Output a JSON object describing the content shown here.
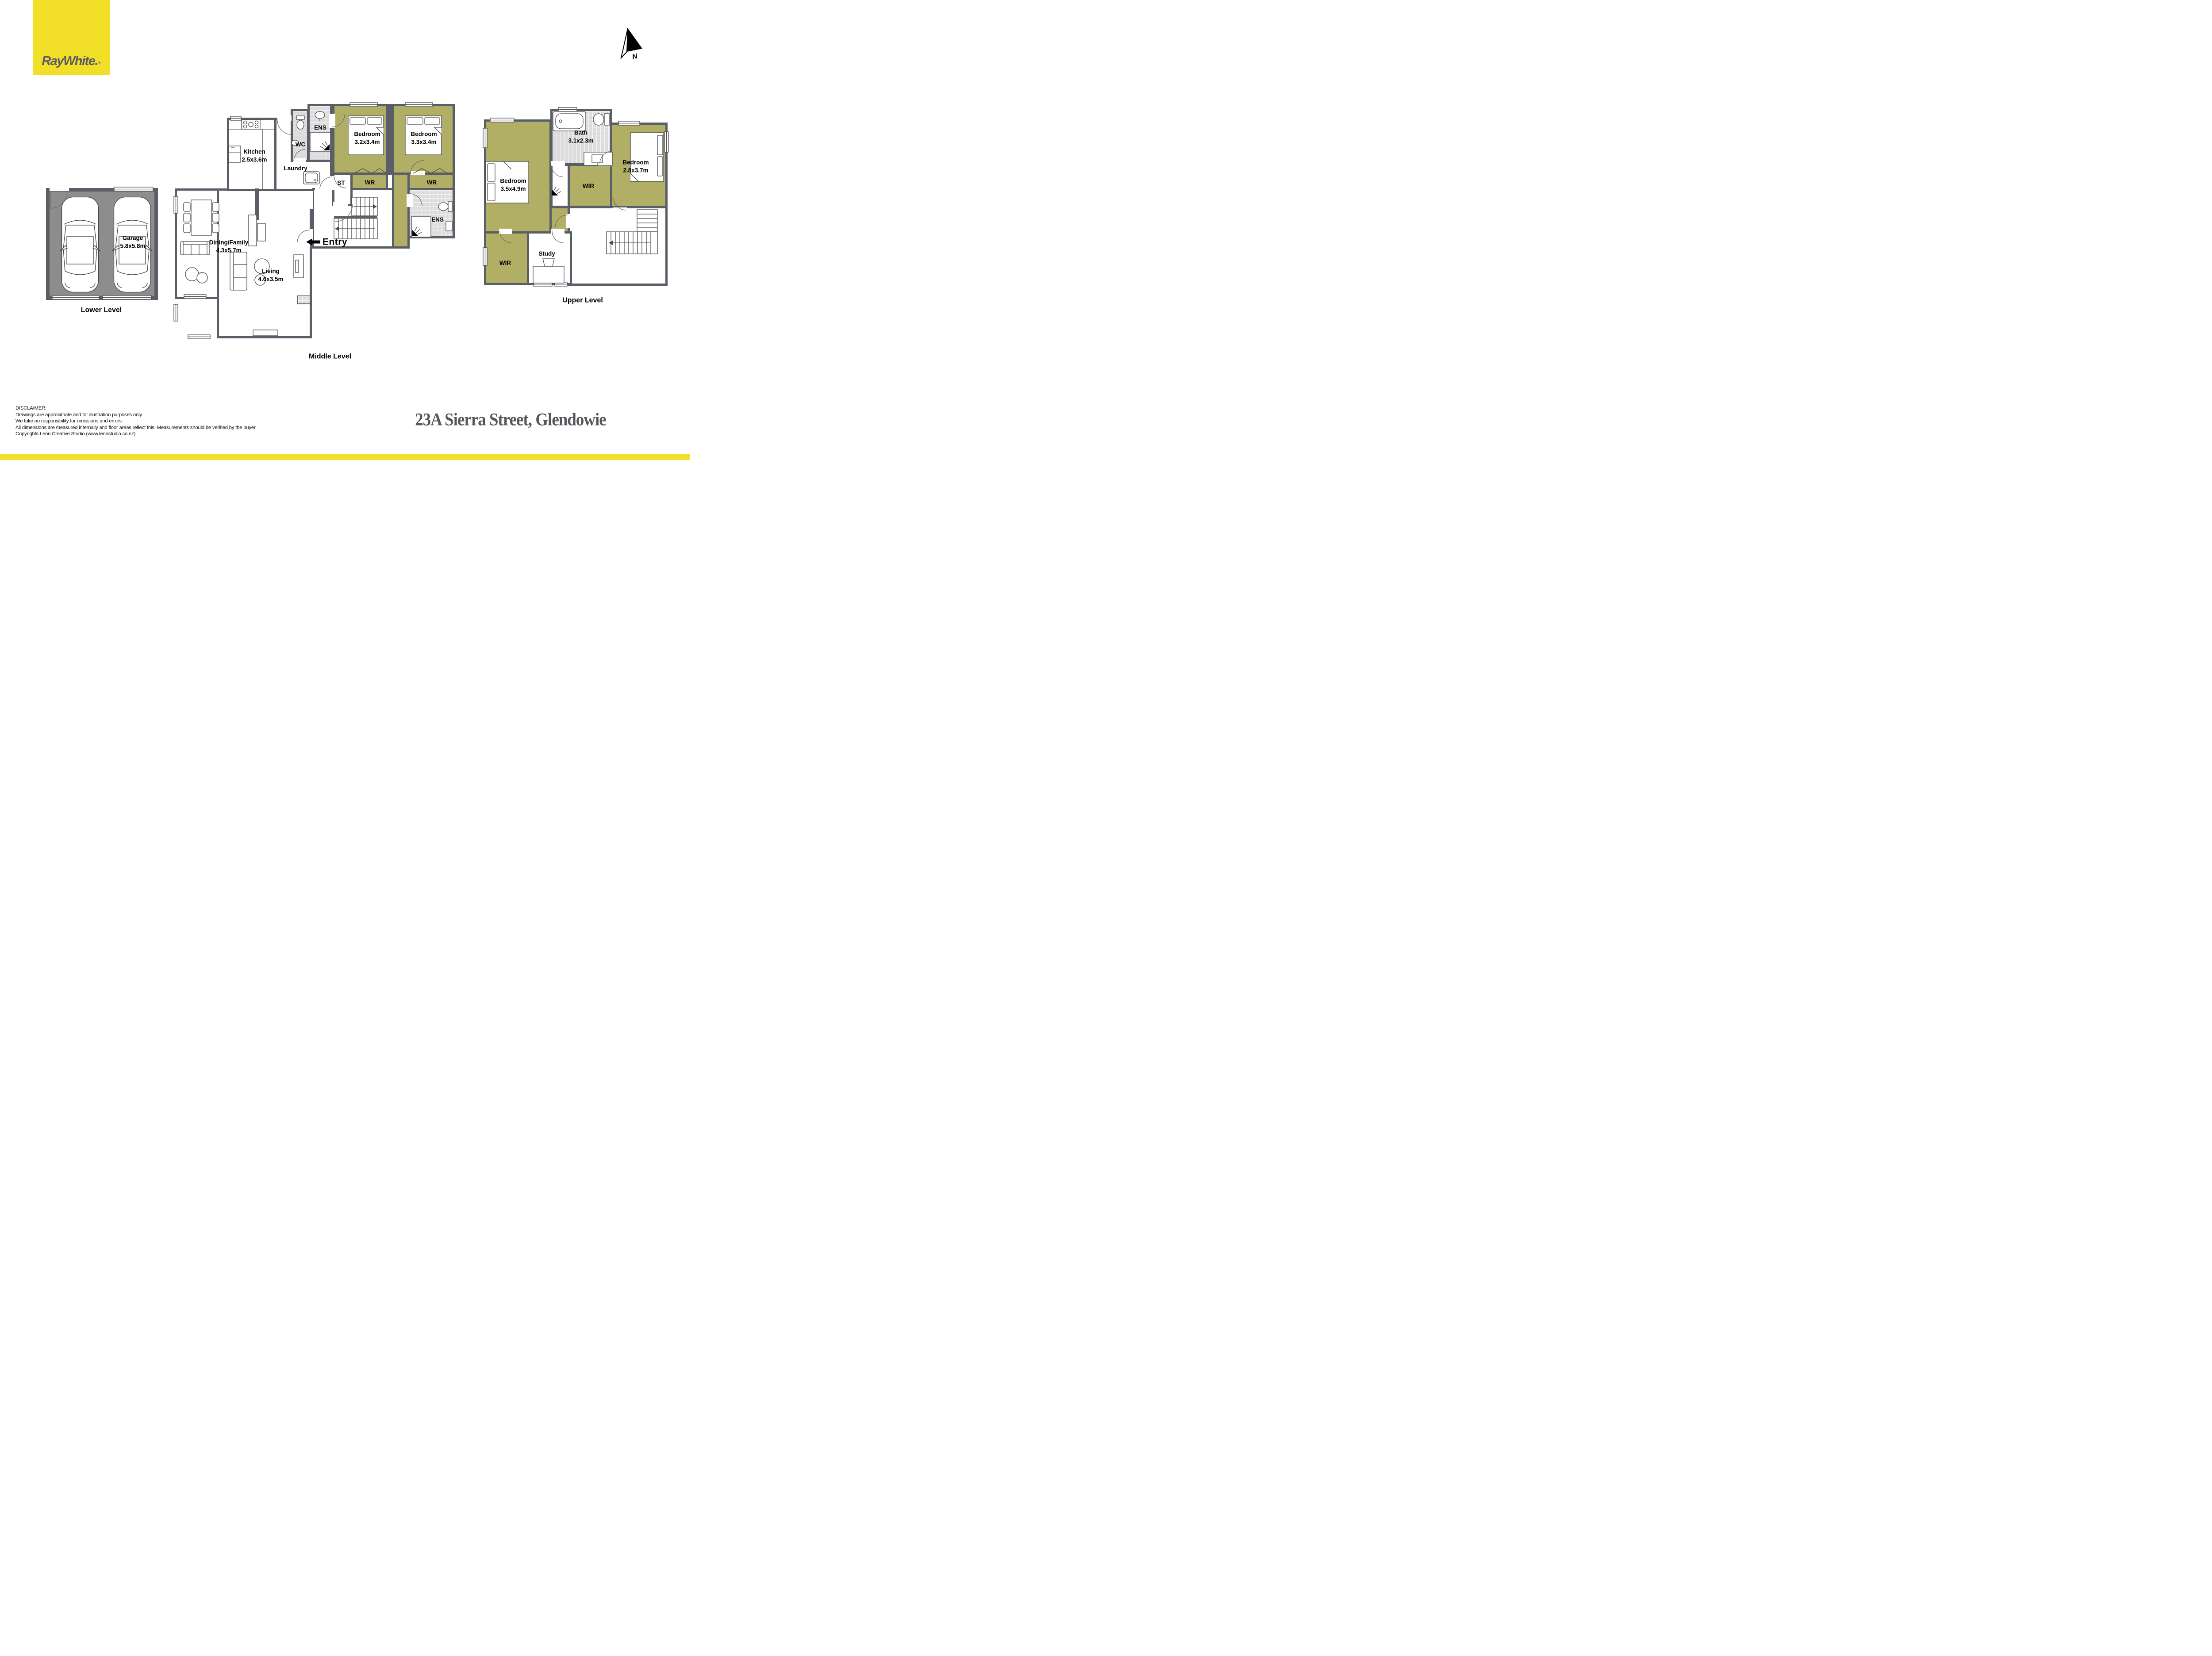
{
  "brand": {
    "name": "RayWhite.",
    "registered": "®"
  },
  "compass": {
    "label": "N"
  },
  "levels": {
    "lower": "Lower Level",
    "middle": "Middle Level",
    "upper": "Upper Level"
  },
  "rooms": {
    "garage": {
      "name": "Garage",
      "dims": "5.8x5.8m"
    },
    "kitchen": {
      "name": "Kitchen",
      "dims": "2.5x3.6m"
    },
    "laundry": {
      "name": "Laundry"
    },
    "wc": {
      "name": "WC"
    },
    "ens_mid": {
      "name": "ENS"
    },
    "bedroom_32": {
      "name": "Bedroom",
      "dims": "3.2x3.4m"
    },
    "bedroom_33": {
      "name": "Bedroom",
      "dims": "3.3x3.4m"
    },
    "st": {
      "name": "ST"
    },
    "wr_a": {
      "name": "WR"
    },
    "wr_b": {
      "name": "WR"
    },
    "ens_mid2": {
      "name": "ENS"
    },
    "dining": {
      "name": "Dining/Family",
      "dims": "4.3x5.7m"
    },
    "living": {
      "name": "Living",
      "dims": "4.6x3.5m"
    },
    "entry": {
      "label": "Entry"
    },
    "bedroom_35": {
      "name": "Bedroom",
      "dims": "3.5x4.9m"
    },
    "bath": {
      "name": "Bath",
      "dims": "3.1x2.3m"
    },
    "bedroom_28": {
      "name": "Bedroom",
      "dims": "2.8x3.7m"
    },
    "wir_mid": {
      "name": "WIR"
    },
    "wir_lower": {
      "name": "WIR"
    },
    "study": {
      "name": "Study"
    }
  },
  "footer": {
    "address": "23A Sierra Street, Glendowie",
    "disclaimer_title": "DISCLAIMER:",
    "disclaimer_lines": [
      "Drawings are approximate and for illustration purposes only.",
      "We take no responsibility for omissions and errors.",
      "All dimensions are measured internally and floor areas reflect this. Measurements should be verified by the buyer.",
      "Copyrights Leon Creative Studio (www.leonstudio.co.nz)"
    ]
  },
  "colors": {
    "brand_yellow": "#f2df27",
    "wall": "#5a5e66",
    "room_olive": "#b1ae65",
    "tile": "#dcdcdc",
    "garage_floor": "#8d8d8d"
  }
}
